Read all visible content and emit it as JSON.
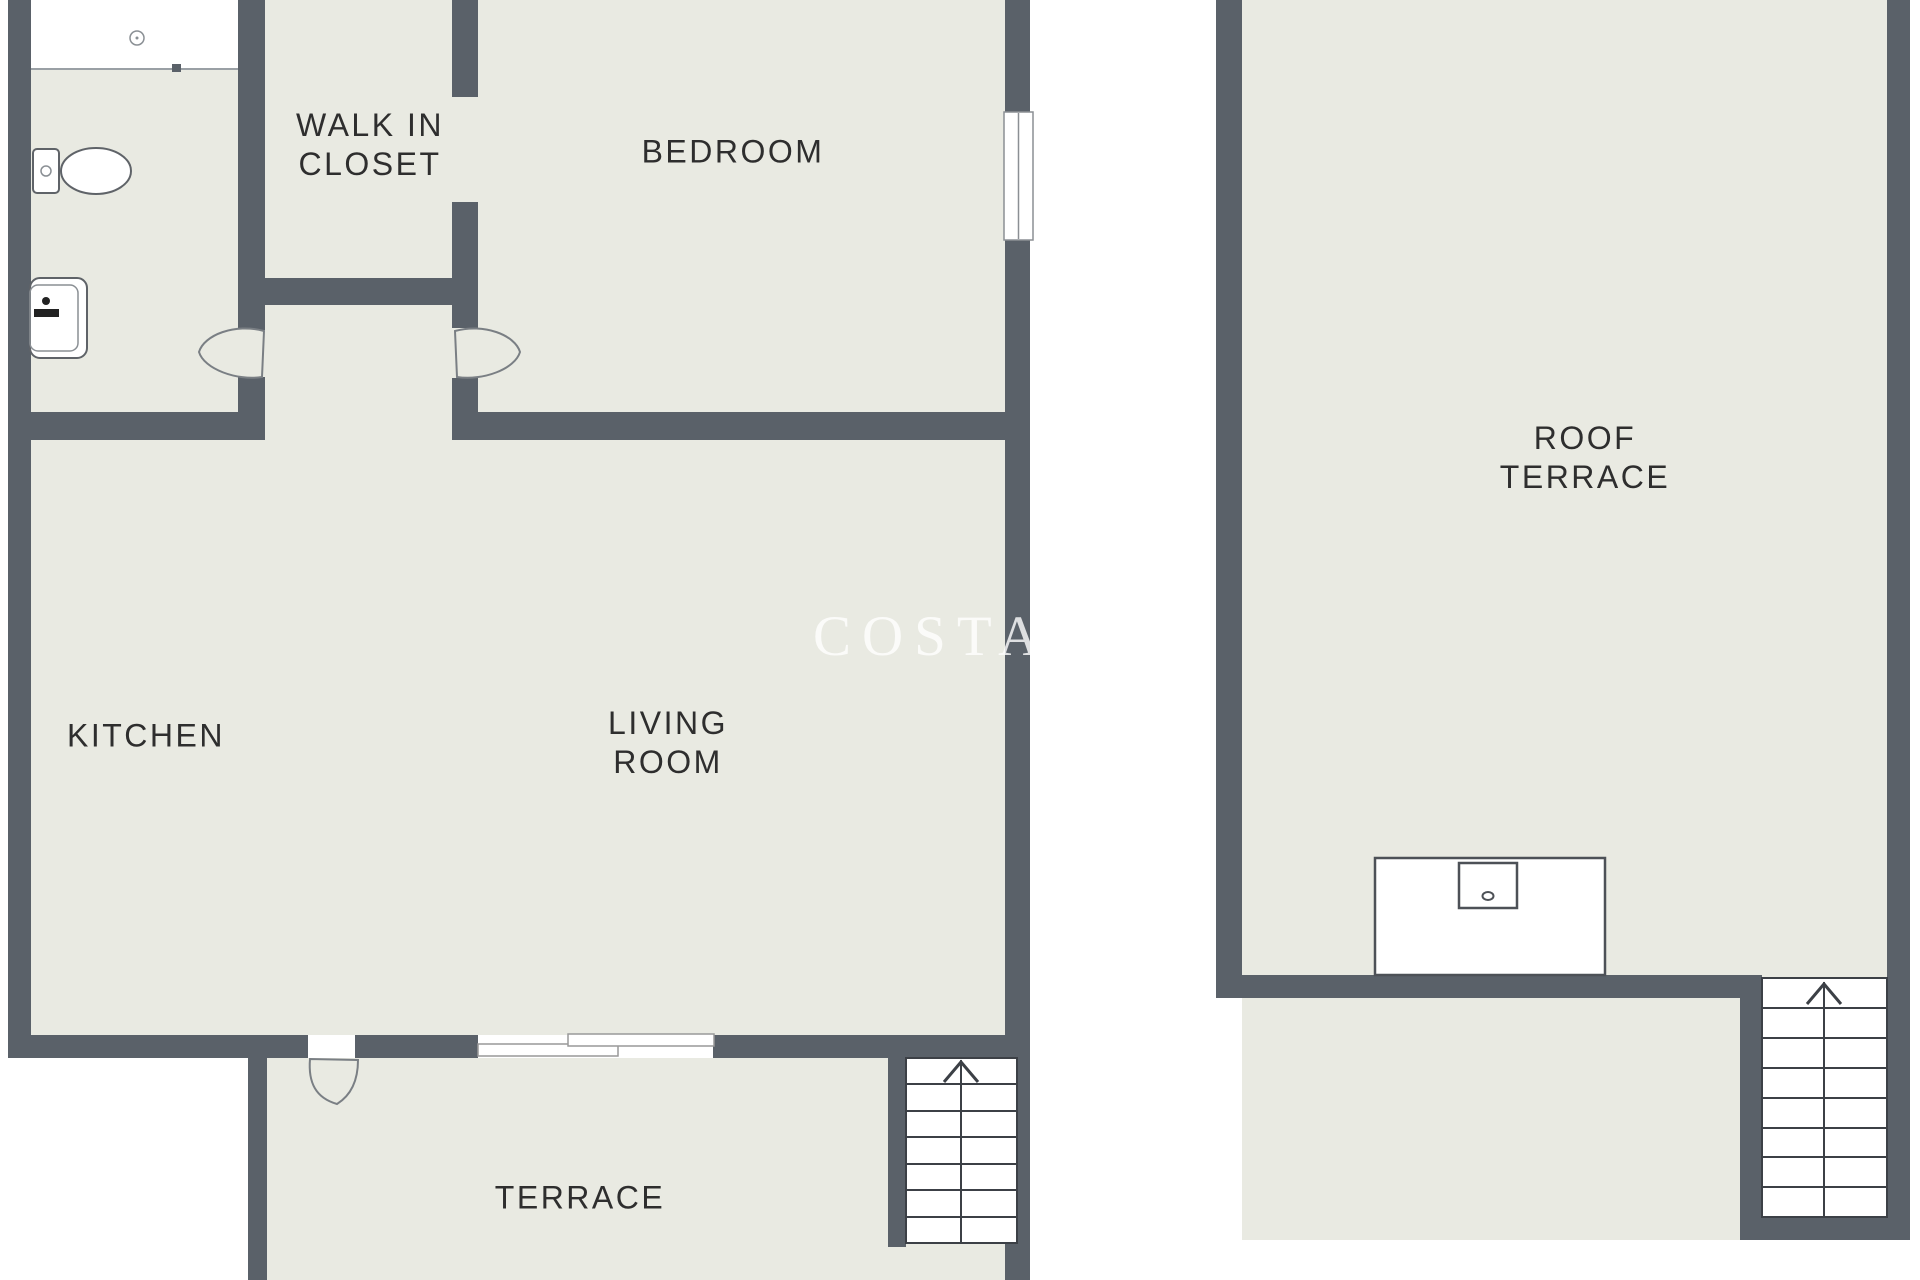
{
  "colors": {
    "background": "#ffffff",
    "floor": "#e9eae2",
    "wall": "#5a6169",
    "tread": "#3c4046",
    "label_text": "#2e2e2e",
    "watermark": "rgba(255,255,255,0.8)"
  },
  "rooms": {
    "walk_in_closet": {
      "label": "WALK IN\nCLOSET"
    },
    "bedroom": {
      "label": "BEDROOM"
    },
    "kitchen": {
      "label": "KITCHEN"
    },
    "living_room": {
      "label": "LIVING\nROOM"
    },
    "terrace": {
      "label": "TERRACE"
    },
    "roof_terrace": {
      "label": "ROOF\nTERRACE"
    }
  },
  "watermark": {
    "main": "COSTA",
    "fragment_top": "GR",
    "fragment_bottom": "ES"
  },
  "icons": {
    "shower_drain": "small circle drain in white shower area",
    "toilet": "top-view toilet with cistern and bowl",
    "washbasin": "rounded basin with faucet dot and bar",
    "door_swing": "curved door leaf arc",
    "sliding_door": "two offset white panels",
    "window": "white strip with center mullion in wall",
    "stairs_up": "stair treads with center line and up arrow",
    "roof_counter_sink": "counter with small sink and faucet"
  }
}
